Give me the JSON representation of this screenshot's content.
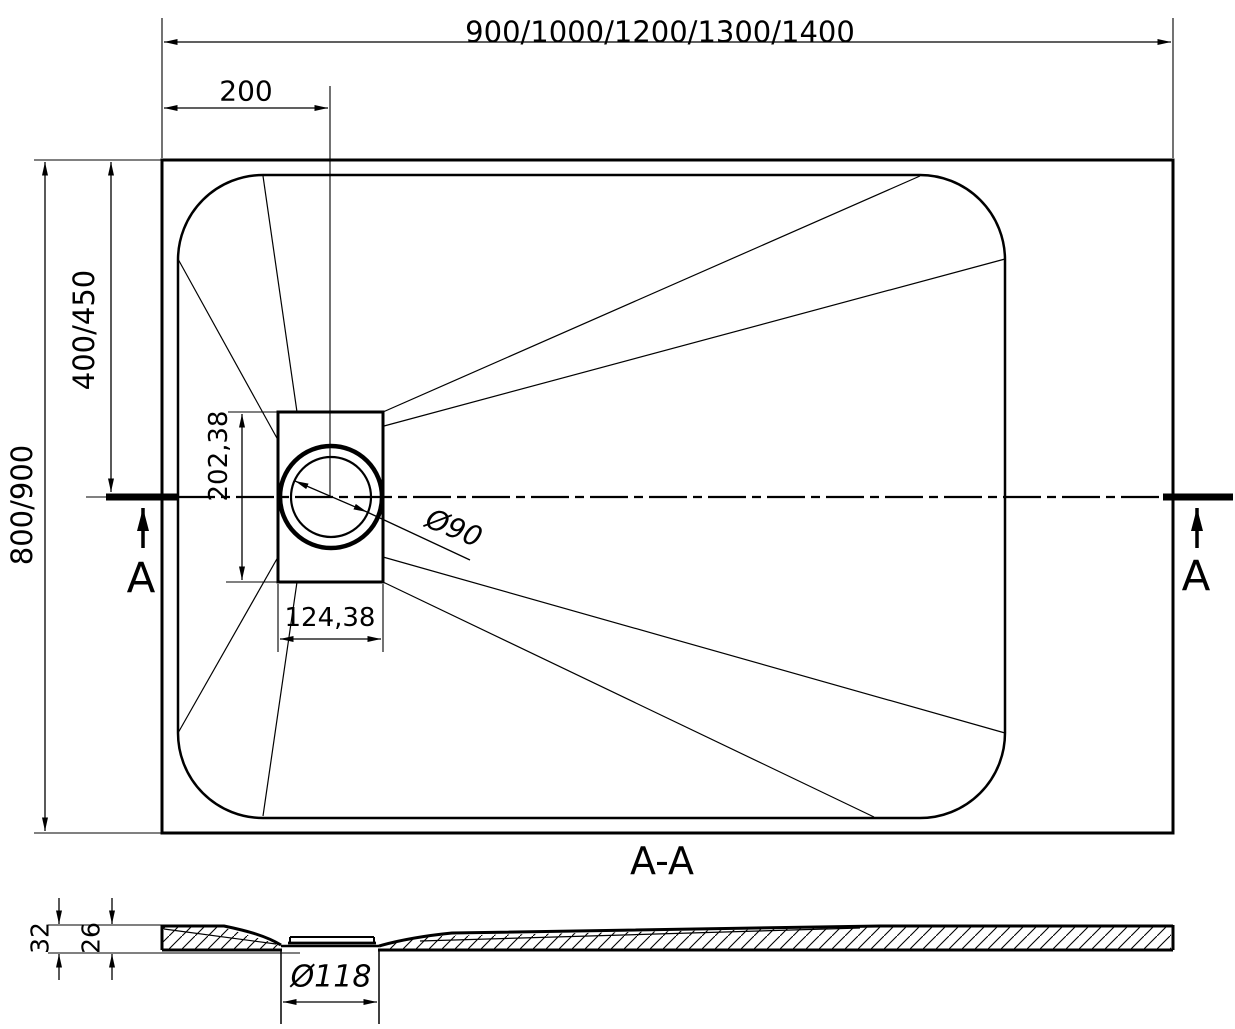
{
  "top_view": {
    "width_label": "900/1000/1200/1300/1400",
    "drain_offset_label": "200",
    "height_label": "800/900",
    "drain_center_y_label": "400/450",
    "drain_recess_height_label": "202,38",
    "drain_recess_width_label": "124,38",
    "drain_diameter_label": "Ø90",
    "section_marker_left": "A",
    "section_marker_right": "A"
  },
  "section_view": {
    "title": "A-A",
    "overall_thickness_label": "32",
    "edge_thickness_label": "26",
    "drain_hole_label": "Ø118"
  },
  "colors": {
    "line": "#000000",
    "background": "#ffffff"
  }
}
